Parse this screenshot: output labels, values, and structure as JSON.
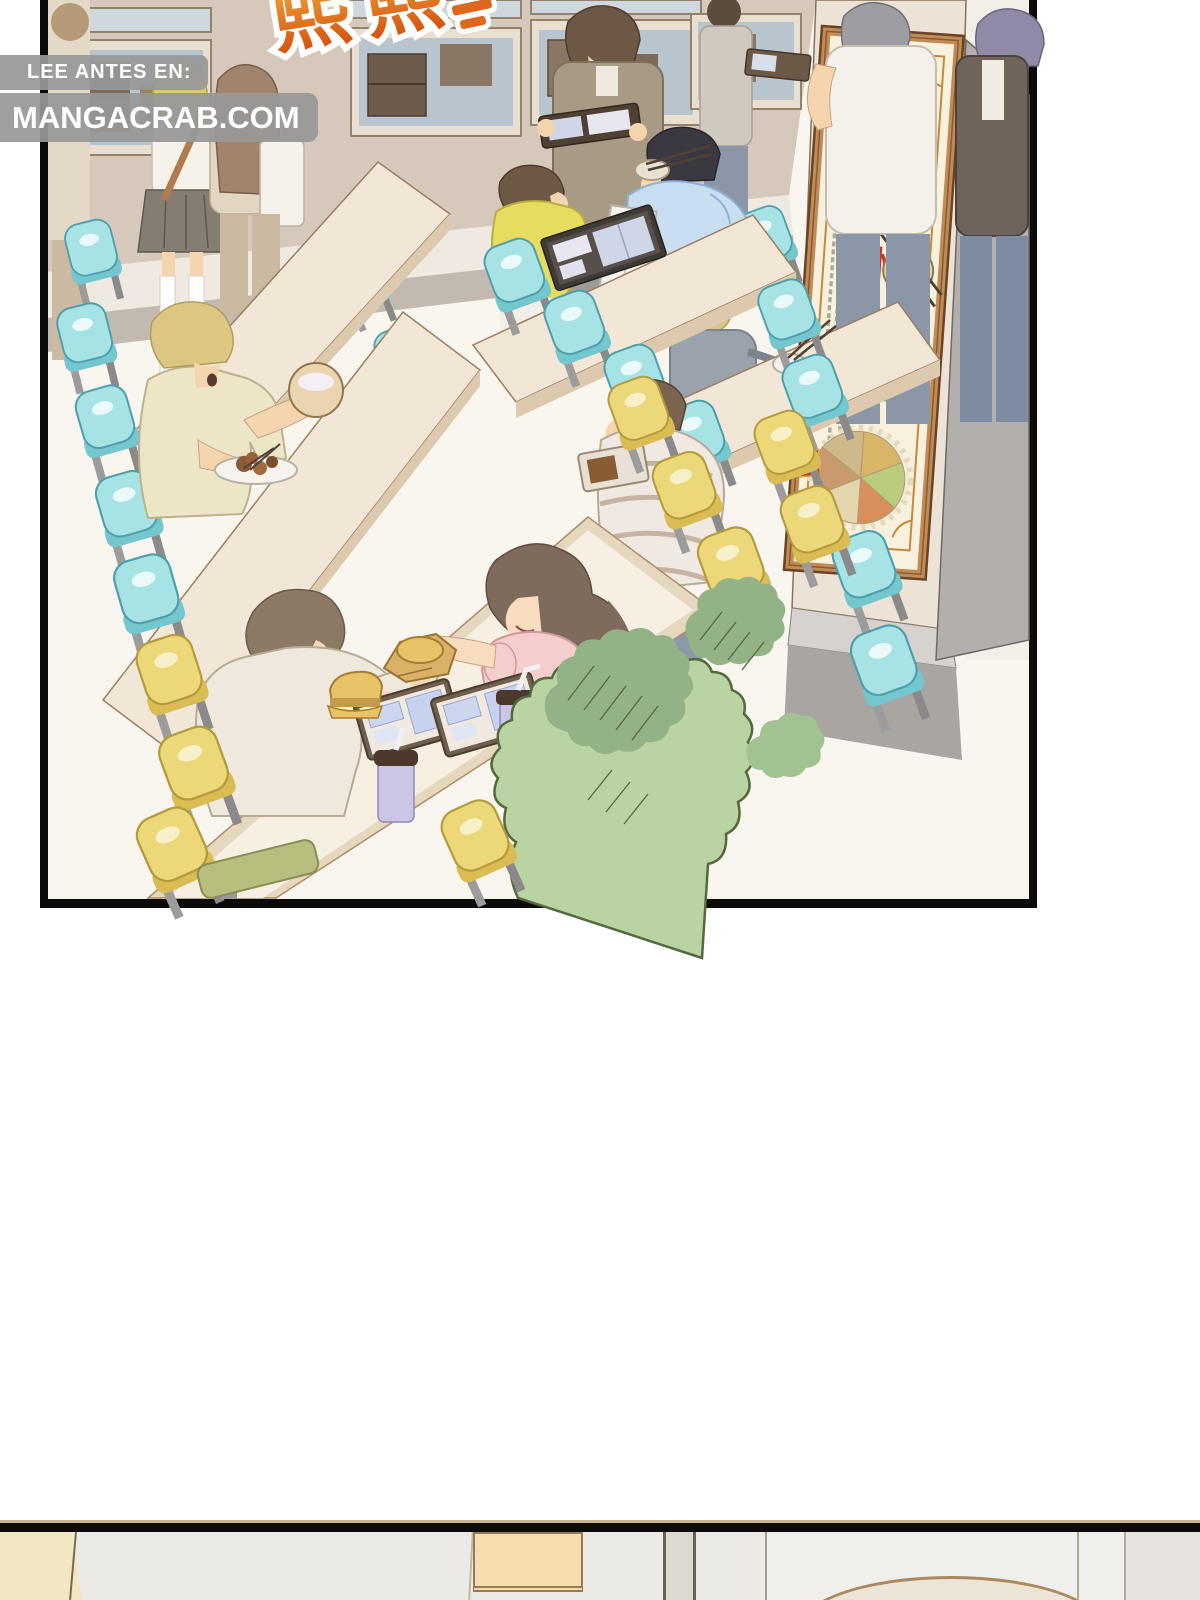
{
  "page": {
    "width": 1200,
    "height": 1600,
    "background": "#ffffff"
  },
  "watermark": {
    "prefix": "LEE ANTES EN:",
    "site": "MANGACRAB.COM",
    "badge_color": "#989898",
    "text_color": "#ffffff"
  },
  "sfx": {
    "text": "熙熙",
    "color_top": "#f2a93b",
    "color_bottom": "#d24e0f",
    "outline_color": "#ffffff"
  },
  "poster": {
    "red_chars": [
      "珍",
      "惜"
    ],
    "green_chars": [
      "粮",
      "食"
    ],
    "red_color": "#c43a2c",
    "green_color": "#4fa24f",
    "paper_color": "#f8f1de",
    "frame_color": "#c08b57"
  },
  "panels": {
    "main": {
      "border_color": "#0d0b09"
    },
    "bottom": {
      "border_color": "#0d0b09"
    }
  },
  "palette": {
    "wall": "#d6c9bc",
    "window_glass": "#b9c5ce",
    "table": "#f2e7d6",
    "chair_cyan": "#a7e2e4",
    "chair_yellow": "#ecd878",
    "bush": "#b9d3a3",
    "skin": "#f5d5ae",
    "pillar_side": "#b2afac"
  }
}
